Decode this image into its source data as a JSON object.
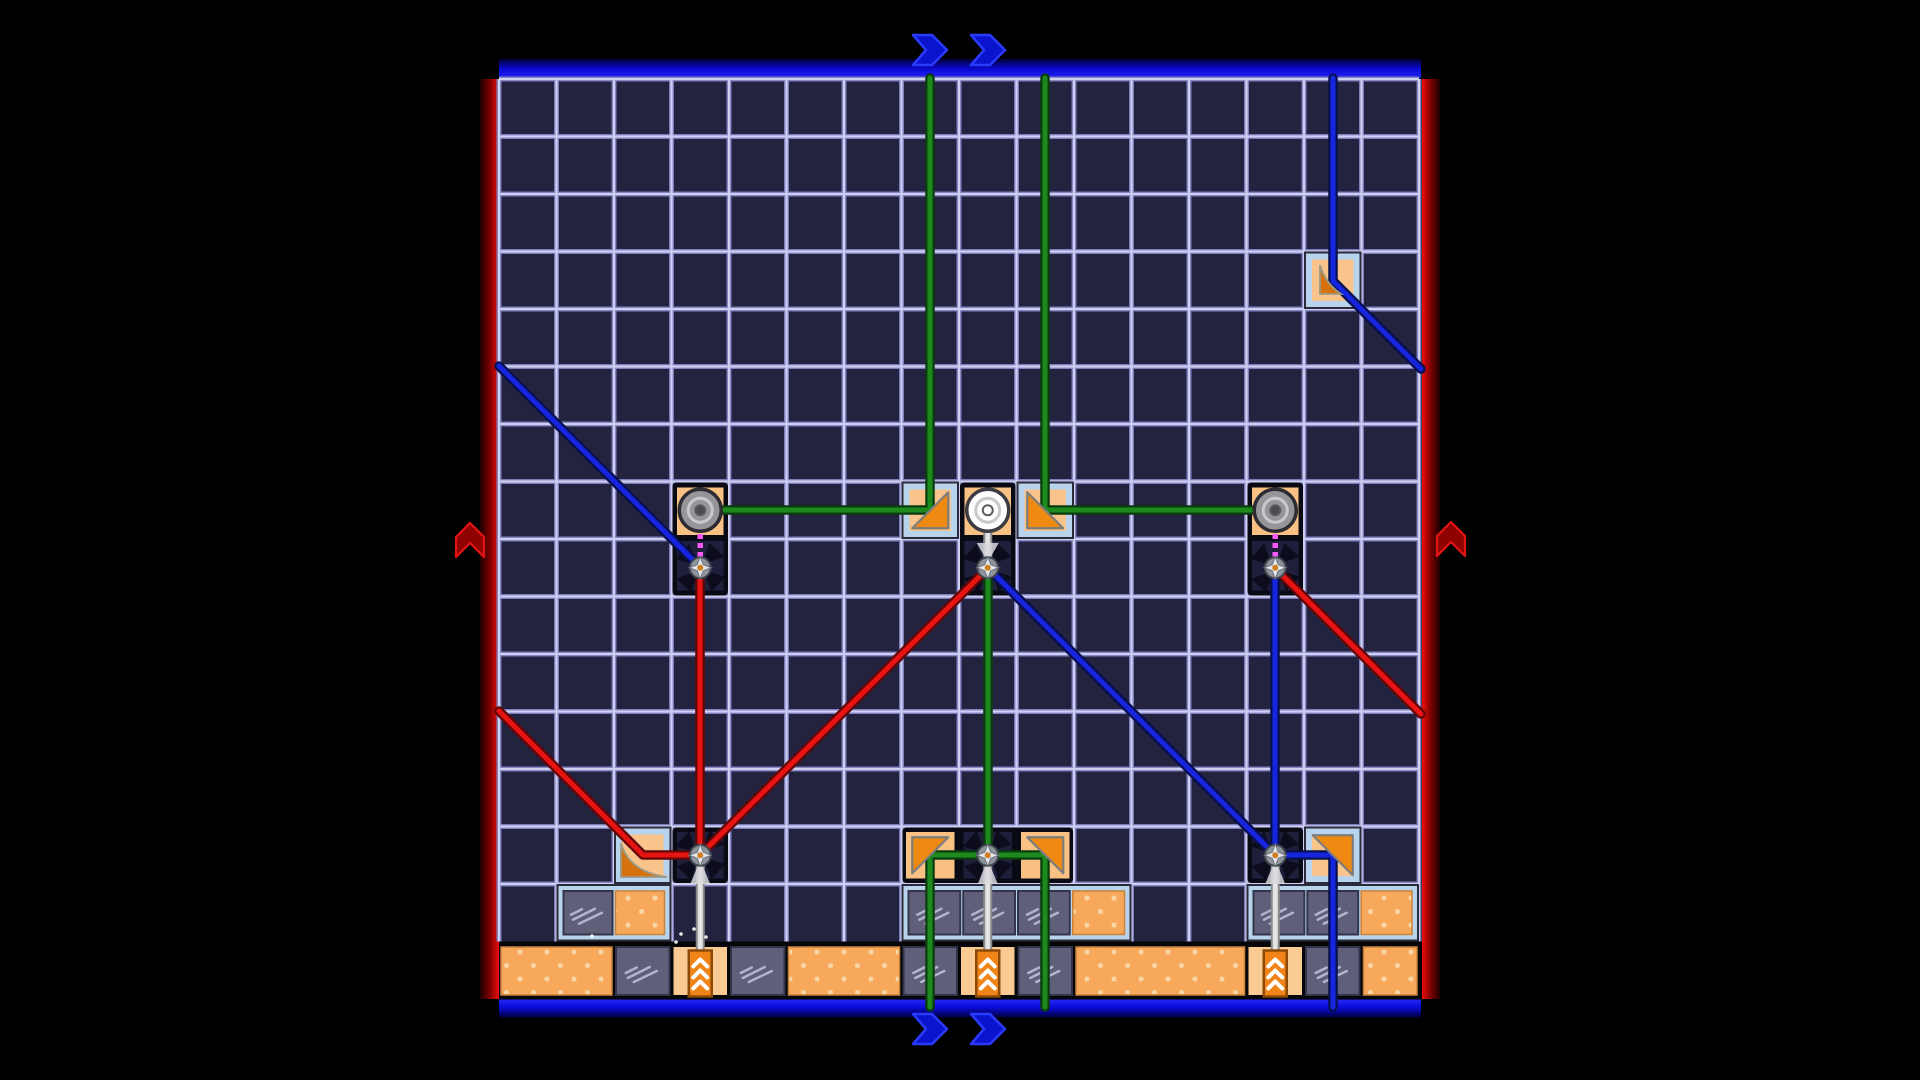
{
  "title": "laser-mirror-puzzle-board",
  "colors": {
    "bg": "#000000",
    "cell": "#232340",
    "grid_glow": "#7d7dbd",
    "grid_core": "#cfcff2",
    "belt_bg": "#060609",
    "band_blue_dark": "#00003a",
    "band_blue_mid": "#0b0bd6",
    "band_blue_bright": "#2525f5",
    "band_red_dark": "#1c0000",
    "band_red_mid": "#7a0000",
    "band_red_bright": "#ee0d0d",
    "chevron_blue_fill": "#0a14cc",
    "chevron_blue_stroke": "#2a3aff",
    "arrow_red_fill": "#8f0202",
    "arrow_red_stroke": "#e51414",
    "beam_green_core": "#1d8a1d",
    "beam_green_edge": "#0a3c0e",
    "beam_red_core": "#e81414",
    "beam_red_edge": "#620606",
    "beam_blue_core": "#1626e0",
    "beam_blue_edge": "#071050",
    "magenta_link": "#f85af8",
    "rod_fill": "#e4e4e4",
    "rod_edge": "#8a8a8a",
    "frame_black": "#0a0a14",
    "device_peach": "#f9c284",
    "pivot_cell": "#1f1f3c",
    "pinwheel": "#0a0a1a",
    "star_disc": "#8e949c",
    "star_disc_edge": "#3f444c",
    "star_fill": "#e4e6ea",
    "star_center": "#cf7f22",
    "knob_gray_body": "#96969a",
    "knob_gray_edge": "#2c2c32",
    "knob_ring": "#c9c9cd",
    "knob_gray_center": "#4a4a50",
    "knob_white_body": "#fdfdfd",
    "knob_white_edge": "#3c3c42",
    "mirror_frame": "#b7d4ec",
    "mirror_frame_edge": "#2a2a3a",
    "mirror_bg": "#f8c48b",
    "mirror_tri": "#ee8a12",
    "mirror_tri_edge": "#7d7d7d",
    "curve_fill": "#d6720e",
    "curve_edge": "#9b9b85",
    "glass_fill": "#5f5f7a",
    "glass_edge": "#33334a",
    "glass_streak": "#b2b6cc",
    "orange_fill": "#f7a85a",
    "orange_dot": "#f9d5a5",
    "piston_cell": "#f9ca94",
    "piston_body": "#f08418",
    "piston_edge": "#8d4a05",
    "piston_chevron": "#ffffff",
    "sparkle": "#ffffff"
  },
  "board": {
    "x": 499,
    "y": 79,
    "cell": 57.5,
    "cols": 16,
    "rows_normal": 15,
    "belt_top": 941.5,
    "belt_bottom": 999
  },
  "borders": {
    "top": {
      "x": 499,
      "y": 59,
      "w": 922,
      "h": 19
    },
    "bottom": {
      "x": 499,
      "y": 999.5,
      "w": 922,
      "h": 18
    },
    "left": {
      "x": 480,
      "y": 79,
      "w": 19,
      "h": 920
    },
    "right": {
      "x": 1422,
      "y": 79,
      "w": 18,
      "h": 920
    }
  },
  "chevrons_blue": [
    {
      "x": 913,
      "y": 35
    },
    {
      "x": 971,
      "y": 35
    },
    {
      "x": 913,
      "y": 1014
    },
    {
      "x": 971,
      "y": 1014
    }
  ],
  "arrows_red": [
    {
      "x": 456,
      "y": 517
    },
    {
      "x": 1437,
      "y": 516
    }
  ],
  "framed_rows": [
    {
      "c0": 1,
      "row": 14,
      "cells": [
        "glass",
        "orange"
      ]
    },
    {
      "c0": 7,
      "row": 14,
      "cells": [
        "glass",
        "glass",
        "glass",
        "orange"
      ]
    },
    {
      "c0": 13,
      "row": 14,
      "cells": [
        "glass",
        "glass",
        "orange"
      ]
    }
  ],
  "belt_cells": [
    {
      "c": 0,
      "span": 2,
      "t": "orange"
    },
    {
      "c": 2,
      "span": 1,
      "t": "glass"
    },
    {
      "c": 3,
      "span": 1,
      "t": "piston"
    },
    {
      "c": 4,
      "span": 1,
      "t": "glass"
    },
    {
      "c": 5,
      "span": 2,
      "t": "orange"
    },
    {
      "c": 7,
      "span": 1,
      "t": "glass"
    },
    {
      "c": 8,
      "span": 1,
      "t": "piston"
    },
    {
      "c": 9,
      "span": 1,
      "t": "glass"
    },
    {
      "c": 10,
      "span": 3,
      "t": "orange"
    },
    {
      "c": 13,
      "span": 1,
      "t": "piston"
    },
    {
      "c": 14,
      "span": 1,
      "t": "glass"
    },
    {
      "c": 15,
      "span": 1,
      "t": "orange"
    }
  ],
  "mirror_cells": [
    {
      "col": 7,
      "row": 7,
      "tri": "br",
      "size": 36
    },
    {
      "col": 9,
      "row": 7,
      "tri": "bl",
      "size": 36
    },
    {
      "col": 14,
      "row": 13,
      "tri": "tr",
      "size": 40
    },
    {
      "col": 14,
      "row": 3,
      "curve": "tr"
    },
    {
      "col": 2,
      "row": 13,
      "curve": "bl"
    }
  ],
  "devices": [
    {
      "col": 3,
      "row": 7,
      "knob": "gray",
      "link": "magenta"
    },
    {
      "col": 8,
      "row": 7,
      "knob": "white",
      "link": "rod"
    },
    {
      "col": 13,
      "row": 7,
      "knob": "gray",
      "link": "magenta"
    }
  ],
  "bottom_pivot_cells": [
    {
      "col": 3,
      "row": 13
    },
    {
      "col": 13,
      "row": 13
    }
  ],
  "bottom_center_unit": {
    "c0": 7,
    "row": 13,
    "cells": [
      {
        "t": "tri",
        "tri": "tl"
      },
      {
        "t": "pivot"
      },
      {
        "t": "tri",
        "tri": "tr"
      }
    ]
  },
  "pivots": [
    [
      3,
      8
    ],
    [
      8,
      8
    ],
    [
      13,
      8
    ],
    [
      3,
      13
    ],
    [
      8,
      13
    ],
    [
      13,
      13
    ]
  ],
  "rods": [
    {
      "col": 8,
      "y1": 516,
      "y2": 562,
      "wedge": "down"
    },
    {
      "col": 3,
      "y1": 862,
      "y2": 956,
      "wedge": "up"
    },
    {
      "col": 8,
      "y1": 862,
      "y2": 956,
      "wedge": "up"
    },
    {
      "col": 13,
      "y1": 862,
      "y2": 956,
      "wedge": "up"
    }
  ],
  "magenta_links": [
    {
      "col": 3,
      "y1": 516,
      "y2": 560
    },
    {
      "col": 13,
      "y1": 516,
      "y2": 560
    }
  ],
  "pistons": [
    {
      "col": 3
    },
    {
      "col": 8
    },
    {
      "col": 13
    }
  ],
  "beams": [
    {
      "c": "green",
      "pts": [
        [
          700,
          510
        ],
        [
          930,
          510
        ],
        [
          930,
          78
        ]
      ]
    },
    {
      "c": "green",
      "pts": [
        [
          1275,
          510
        ],
        [
          1045,
          510
        ],
        [
          1045,
          78
        ]
      ]
    },
    {
      "c": "green",
      "pts": [
        [
          988,
          568
        ],
        [
          988,
          855
        ]
      ]
    },
    {
      "c": "green",
      "pts": [
        [
          988,
          855
        ],
        [
          930,
          855
        ],
        [
          930,
          1007
        ]
      ]
    },
    {
      "c": "green",
      "pts": [
        [
          988,
          855
        ],
        [
          1045,
          855
        ],
        [
          1045,
          1007
        ]
      ]
    },
    {
      "c": "red",
      "pts": [
        [
          700,
          568
        ],
        [
          700,
          855
        ]
      ]
    },
    {
      "c": "red",
      "pts": [
        [
          988,
          568
        ],
        [
          700,
          855
        ]
      ]
    },
    {
      "c": "red",
      "pts": [
        [
          499,
          711
        ],
        [
          643,
          855
        ],
        [
          700,
          855
        ]
      ]
    },
    {
      "c": "red",
      "pts": [
        [
          1421,
          714
        ],
        [
          1275,
          568
        ]
      ]
    },
    {
      "c": "blue",
      "pts": [
        [
          499,
          366
        ],
        [
          700,
          567
        ]
      ]
    },
    {
      "c": "blue",
      "pts": [
        [
          1275,
          568
        ],
        [
          1275,
          855
        ]
      ]
    },
    {
      "c": "blue",
      "pts": [
        [
          988,
          568
        ],
        [
          1275,
          855
        ]
      ]
    },
    {
      "c": "blue",
      "pts": [
        [
          1275,
          855
        ],
        [
          1333,
          855
        ],
        [
          1333,
          1007
        ]
      ]
    },
    {
      "c": "blue",
      "pts": [
        [
          1333,
          78
        ],
        [
          1333,
          281
        ],
        [
          1421,
          369
        ]
      ]
    }
  ],
  "sparkles": [
    [
      681,
      934
    ],
    [
      694,
      929
    ],
    [
      706,
      937
    ],
    [
      592,
      936
    ],
    [
      676,
      942
    ]
  ]
}
